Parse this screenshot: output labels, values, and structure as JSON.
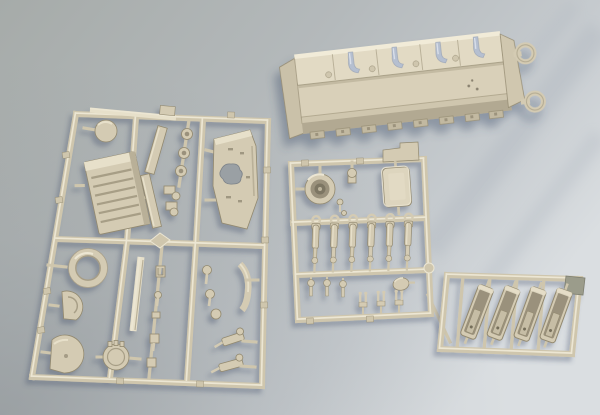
{
  "scene": {
    "description": "Photograph of a plastic scale-model tank kit: three beige injection-molded sprues of parts plus a separate lower-hull tub, laid out on a blue-grey surface lit from the upper right",
    "objects": [
      {
        "id": "lower-hull",
        "label": "lower hull tub (large loose part) with two round ring mounts at the right end and pale blue interior brackets",
        "position": "top-right"
      },
      {
        "id": "sprue-large",
        "label": "large sprue: engine grille, roof plate with irregular opening, circular disc, turret-race ring, half disc, two hatch discs, long flat bars, wheel hubs and many small fittings",
        "position": "left"
      },
      {
        "id": "sprue-medium",
        "label": "medium sprue: round turret ring part, rectangular hatch door, six shock-absorber cylinders, small pins and forked fittings, oval disc",
        "position": "center-right"
      },
      {
        "id": "sprue-small",
        "label": "small sprue: four slanted open trough / fender parts and one dark molded tab",
        "position": "bottom-right"
      }
    ],
    "part_counts": {
      "shock_absorbers": 6,
      "trough_parts": 4,
      "hull_rings": 2,
      "wheel_hubs": 3,
      "hull_interior_brackets": 4,
      "hull_sponson_blocks": 8
    },
    "palette": {
      "bgTopLeft": "#a6aba9",
      "bgMid": "#b4b9bb",
      "bgBottomRight": "#dadee1",
      "bgCornerDark": "#878d91",
      "rail": "#cfc6ad",
      "railHi": "#ece6d3",
      "base": "#d4cbb3",
      "light": "#e7e0ca",
      "mid": "#b9b098",
      "dark": "#a79e86",
      "edge": "#92896f",
      "cavity": "#9a917b",
      "deep": "#756e5a",
      "hullFloor": "#d9d0b9",
      "hullFarWall": "#e2dac4",
      "hullNearWall": "#b2a992",
      "hullRim": "#f1ebd8",
      "bluish": "#b5bfd0",
      "darkTab": "#9b9c8b",
      "shadow": "#3f4f6b"
    }
  },
  "geometry": {
    "shock_absorbers": [
      {
        "x": 315.5,
        "y": 240,
        "rot": 2
      },
      {
        "x": 334,
        "y": 239.5,
        "rot": 2
      },
      {
        "x": 352.5,
        "y": 239,
        "rot": 2
      },
      {
        "x": 371,
        "y": 238.5,
        "rot": 2
      },
      {
        "x": 389.5,
        "y": 238,
        "rot": 2
      },
      {
        "x": 408,
        "y": 237.5,
        "rot": 2
      }
    ],
    "troughs": [
      {
        "x": 477,
        "y": 312,
        "rot": 21
      },
      {
        "x": 503.5,
        "y": 313,
        "rot": 21
      },
      {
        "x": 530,
        "y": 314,
        "rot": 20
      },
      {
        "x": 556,
        "y": 315.5,
        "rot": 20
      }
    ],
    "wheel_hubs": [
      {
        "x": 187,
        "y": 134,
        "rot": 0
      },
      {
        "x": 184,
        "y": 153,
        "rot": 0
      },
      {
        "x": 181,
        "y": 171,
        "rot": 0
      }
    ],
    "hull_brackets": [
      {
        "x": 352,
        "y": 46,
        "rot": 0
      },
      {
        "x": 396,
        "y": 46,
        "rot": 0
      },
      {
        "x": 440,
        "y": 46,
        "rot": 0
      },
      {
        "x": 478,
        "y": 45,
        "rot": 0
      }
    ],
    "hull_sponsons": [
      {
        "x": 312,
        "y": 120,
        "rot": 0
      },
      {
        "x": 338,
        "y": 120,
        "rot": 0
      },
      {
        "x": 364,
        "y": 120,
        "rot": 0
      },
      {
        "x": 390,
        "y": 120,
        "rot": 0
      },
      {
        "x": 416,
        "y": 120,
        "rot": 0
      },
      {
        "x": 442,
        "y": 120,
        "rot": 0
      },
      {
        "x": 468,
        "y": 120,
        "rot": 0
      },
      {
        "x": 492,
        "y": 120,
        "rot": 0
      }
    ],
    "bottom_pins": [
      {
        "x": 311,
        "y": 291,
        "rot": 0
      },
      {
        "x": 327,
        "y": 291,
        "rot": 0
      },
      {
        "x": 343,
        "y": 292,
        "rot": 0
      }
    ],
    "ear_parts": [
      {
        "x": 363,
        "y": 300,
        "rot": 0
      },
      {
        "x": 381,
        "y": 299,
        "rot": 0
      },
      {
        "x": 399,
        "y": 298,
        "rot": 0
      }
    ],
    "rail_stubs": [
      {
        "x": 66,
        "y": 155,
        "rot": -9
      },
      {
        "x": 59,
        "y": 200,
        "rot": -9
      },
      {
        "x": 47,
        "y": 291,
        "rot": -9
      },
      {
        "x": 41,
        "y": 330,
        "rot": -9
      },
      {
        "x": 267,
        "y": 170,
        "rot": -1
      },
      {
        "x": 265,
        "y": 240,
        "rot": -1
      },
      {
        "x": 264,
        "y": 305,
        "rot": -1
      },
      {
        "x": 231,
        "y": 115,
        "rot": 2
      },
      {
        "x": 120,
        "y": 381,
        "rot": 2
      },
      {
        "x": 200,
        "y": 384,
        "rot": 2
      },
      {
        "x": 305,
        "y": 163,
        "rot": -2
      },
      {
        "x": 360,
        "y": 161,
        "rot": -2
      },
      {
        "x": 310,
        "y": 321,
        "rot": -2
      },
      {
        "x": 370,
        "y": 319,
        "rot": -2
      }
    ]
  }
}
